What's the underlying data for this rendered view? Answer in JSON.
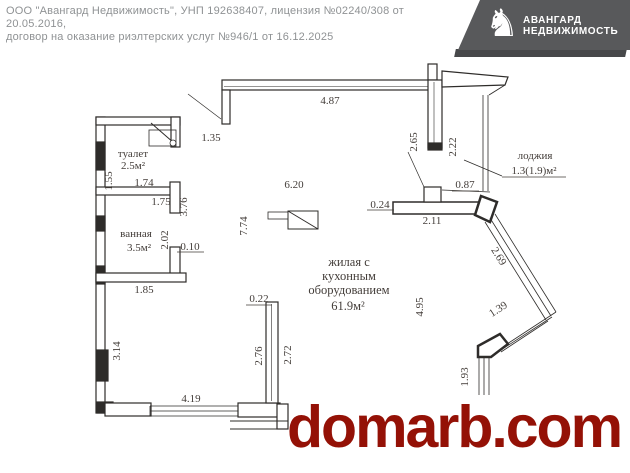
{
  "header": {
    "line1": "ООО \"Авангард Недвижимость\", УНП 192638407, лицензия №02240/308 от 20.05.2016,",
    "line2": "договор на оказание риэлтерских услуг №946/1 от 16.12.2025"
  },
  "logo": {
    "title_line1": "АВАНГАРД",
    "title_line2": "НЕДВИЖИМОСТЬ",
    "icon": "horse-rider-flag",
    "icon_glyph": "♞",
    "bg_color": "#58595b"
  },
  "watermark": {
    "text": "domarb.com",
    "color": "#941106"
  },
  "plan": {
    "rooms": {
      "toilet": {
        "name": "туалет",
        "area": "2.5м²"
      },
      "bath": {
        "name": "ванная",
        "area": "3.5м²"
      },
      "living": {
        "name_line1": "жилая с",
        "name_line2": "кухонным",
        "name_line3": "оборудованием",
        "area": "61.9м²"
      },
      "loggia": {
        "name": "лоджия",
        "area": "1.3(1.9)м²"
      }
    },
    "dims": {
      "d487": "4.87",
      "d135": "1.35",
      "d265": "2.65",
      "d222": "2.22",
      "d087": "0.87",
      "d620": "6.20",
      "d174": "1.74",
      "d175": "1.75",
      "d376": "3.76",
      "d155": "1.55",
      "d774": "7.74",
      "d024": "0.24",
      "d211": "2.11",
      "d202": "2.02",
      "d010": "0.10",
      "d269": "2.69",
      "d185": "1.85",
      "d022": "0.22",
      "d495": "4.95",
      "d139": "1.39",
      "d314": "3.14",
      "d276": "2.76",
      "d272": "2.72",
      "d419": "4.19",
      "d193": "1.93"
    }
  }
}
